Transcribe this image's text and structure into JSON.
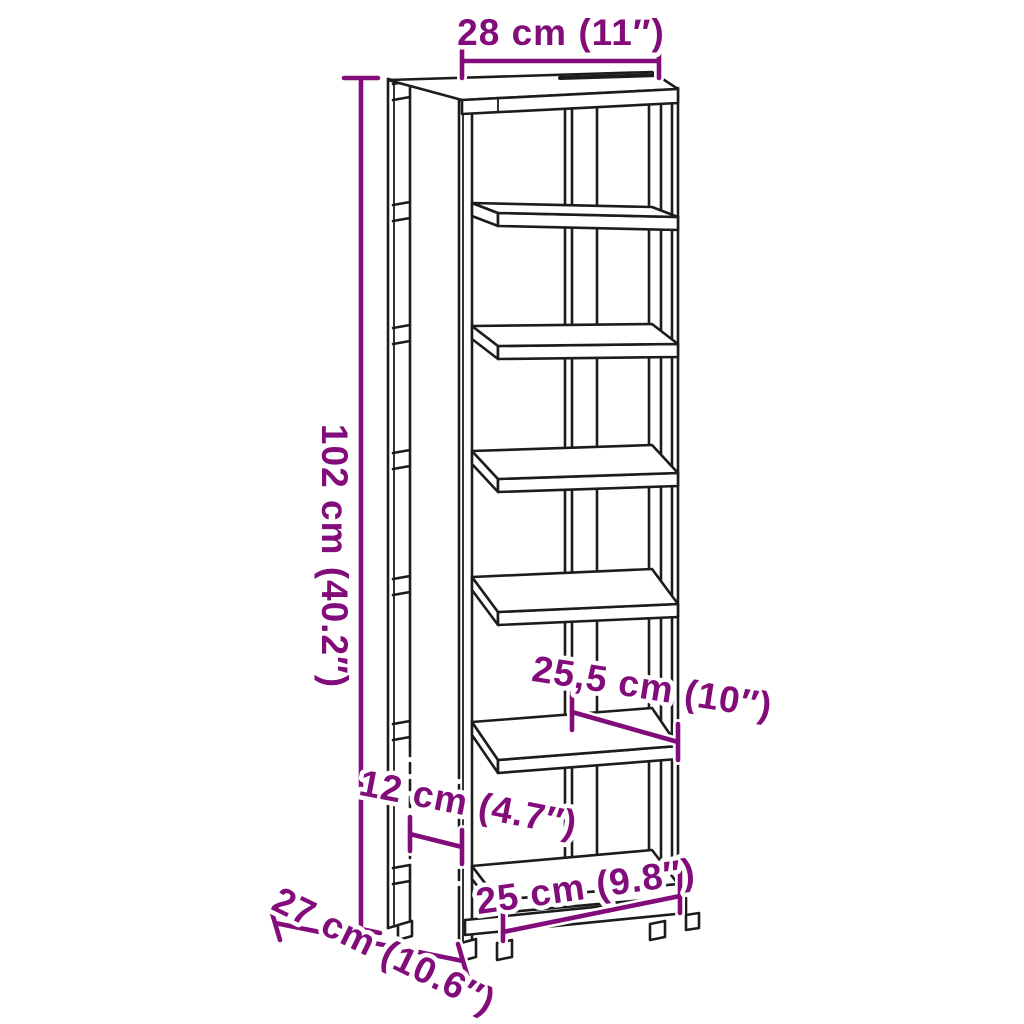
{
  "figure": {
    "type": "product-dimension-diagram",
    "product": "tall open shoe rack line drawing",
    "shelf_count": 7,
    "background_color": "#ffffff",
    "line_color": "#1c1c1c",
    "accent_color": "#820c7a"
  },
  "dimensions": {
    "top_width": {
      "label": "28 cm (11″)"
    },
    "height": {
      "label": "102 cm (40.2″)"
    },
    "shelf_depth": {
      "label": "25,5 cm (10″)"
    },
    "side_gap": {
      "label": "12 cm (4.7″)"
    },
    "bottom_width": {
      "label": "25 cm (9.8″)"
    },
    "depth": {
      "label": "27 cm (10.6″)"
    }
  }
}
